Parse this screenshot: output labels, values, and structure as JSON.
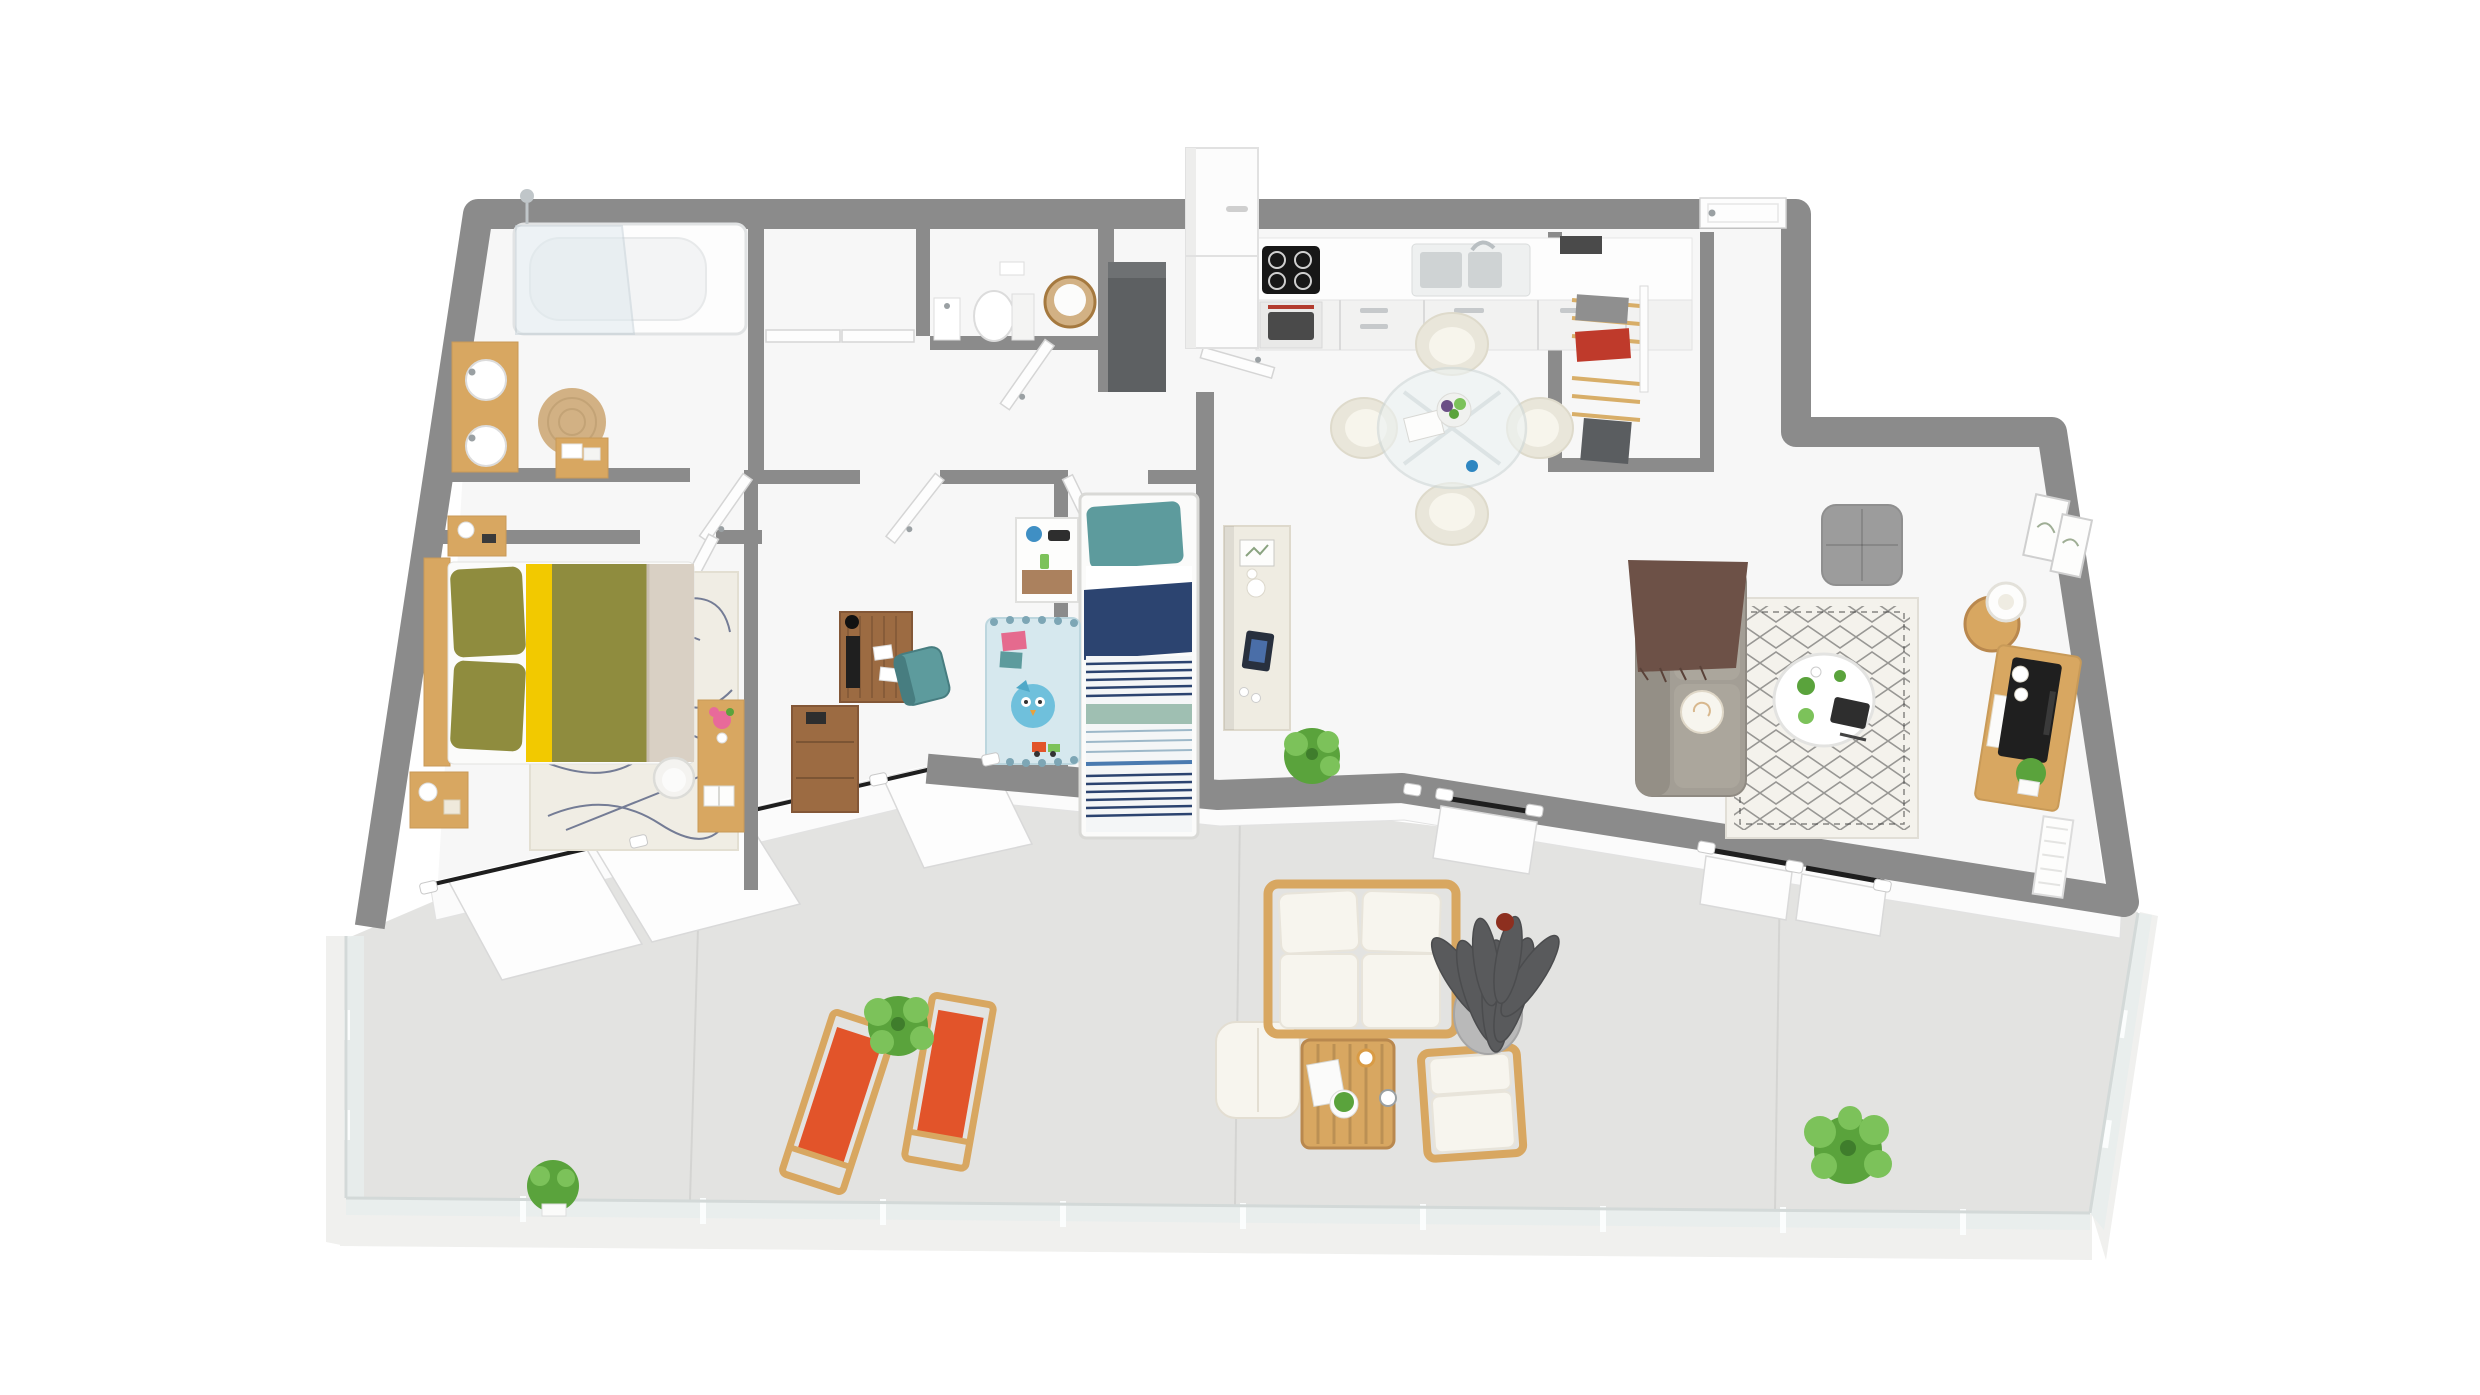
{
  "meta": {
    "title": "3D isometric floor plan of a two-bedroom apartment with large terrace"
  },
  "colors": {
    "wall": "#8b8b8b",
    "floor": "#f7f7f7",
    "terrace": "#e3e3e1",
    "slab": "#f0f0ee",
    "glass": "#e7edec",
    "wood": "#d8a761",
    "woodDark": "#b9884e",
    "walnut": "#9c6b42",
    "white": "#ffffff",
    "offWhite": "#f2f2f1",
    "cream": "#efece2",
    "cushion": "#f7f5ee",
    "olive": "#8f8c3e",
    "yellow": "#f2c900",
    "beige": "#d9d0c4",
    "navy": "#2c4470",
    "teal": "#5d9b9d",
    "sage": "#9fbfb2",
    "lightBlue": "#d6e8ee",
    "owlBlue": "#6fc0dc",
    "orange": "#e2542a",
    "red": "#bf3a2b",
    "brown": "#6d5147",
    "sofaGray": "#a39e95",
    "poufGray": "#9c9c9c",
    "darkGray": "#5d6062",
    "parasol": "#595a5c",
    "green": "#5aa33c",
    "greenLight": "#7cc25a",
    "tan": "#d2b184",
    "chrome": "#c2c9cc",
    "lineDark": "#1e1e1e"
  },
  "scene": {
    "rooms": [
      {
        "id": "bathroom",
        "name": "bathroom",
        "furniture": [
          "bathtub with glass shower screen",
          "wall shower head",
          "double round-basin wood vanity",
          "round jute rug",
          "wooden slatted stool with towels"
        ]
      },
      {
        "id": "storage-closet",
        "name": "hall closet",
        "furniture": [
          "double white closet doors"
        ]
      },
      {
        "id": "wc",
        "name": "toilet room",
        "furniture": [
          "toilet",
          "small hand basin",
          "rattan laundry basket"
        ]
      },
      {
        "id": "corridor",
        "name": "corridor",
        "furniture": [
          "open white interior doors"
        ]
      },
      {
        "id": "master-bedroom",
        "name": "master bedroom",
        "furniture": [
          "double bed with olive and yellow bedding",
          "wooden headboard",
          "two wooden nightstands with lamps",
          "cream rug with navy line pattern",
          "small dressing table with pink flowers",
          "white chair"
        ]
      },
      {
        "id": "office-bedroom",
        "name": "study bedroom",
        "furniture": [
          "walnut desk with monitor and camera",
          "teal desk chair",
          "walnut chest of drawers"
        ]
      },
      {
        "id": "kids-bedroom",
        "name": "kids bedroom",
        "furniture": [
          "single bed with navy striped duvet",
          "teal pillow",
          "white nightstand with blue lamp",
          "light blue owl play rug",
          "toys and picture books"
        ]
      },
      {
        "id": "kitchen",
        "name": "kitchen",
        "furniture": [
          "tall white fridge column",
          "dark gray tall cabinet",
          "black induction hob",
          "built-in oven",
          "double sink with faucet",
          "white base cabinets"
        ]
      },
      {
        "id": "dining-area",
        "name": "dining area",
        "furniture": [
          "round glass table with chrome legs",
          "four cream swivel chairs",
          "fruit bowl",
          "magazine",
          "blue cup"
        ]
      },
      {
        "id": "dressing",
        "name": "dressing nook",
        "furniture": [
          "open wardrobe with wooden hangers",
          "gray and red clothes"
        ]
      },
      {
        "id": "entry",
        "name": "entrance",
        "furniture": [
          "white entrance door"
        ]
      },
      {
        "id": "living-room",
        "name": "living room",
        "furniture": [
          "gray fabric sofa with brown throw and cream cushion",
          "berber pattern rug",
          "round white coffee table with plants and tablet",
          "gray pouf",
          "oak TV unit with television and plant",
          "round oak side table with white lamp",
          "two leaning picture frames",
          "white radiator",
          "indoor green plant",
          "cream sideboard with frame, vase and tablet"
        ]
      }
    ],
    "terrace": {
      "id": "terrace",
      "name": "terrace",
      "furniture": [
        "two orange wooden deck chairs",
        "potted shrub",
        "wooden two-seat garden sofa with white cushions",
        "wooden garden armchair",
        "wooden slatted coffee table with plant, mugs and newspaper",
        "white garden pouf",
        "closed dark gray parasol with round base",
        "large green plant",
        "small potted plant",
        "glass balustrade"
      ]
    },
    "counts": {
      "dining_chairs": 4,
      "deck_chairs": 2,
      "living_room_windows": 3,
      "interior_doors": 7
    }
  }
}
